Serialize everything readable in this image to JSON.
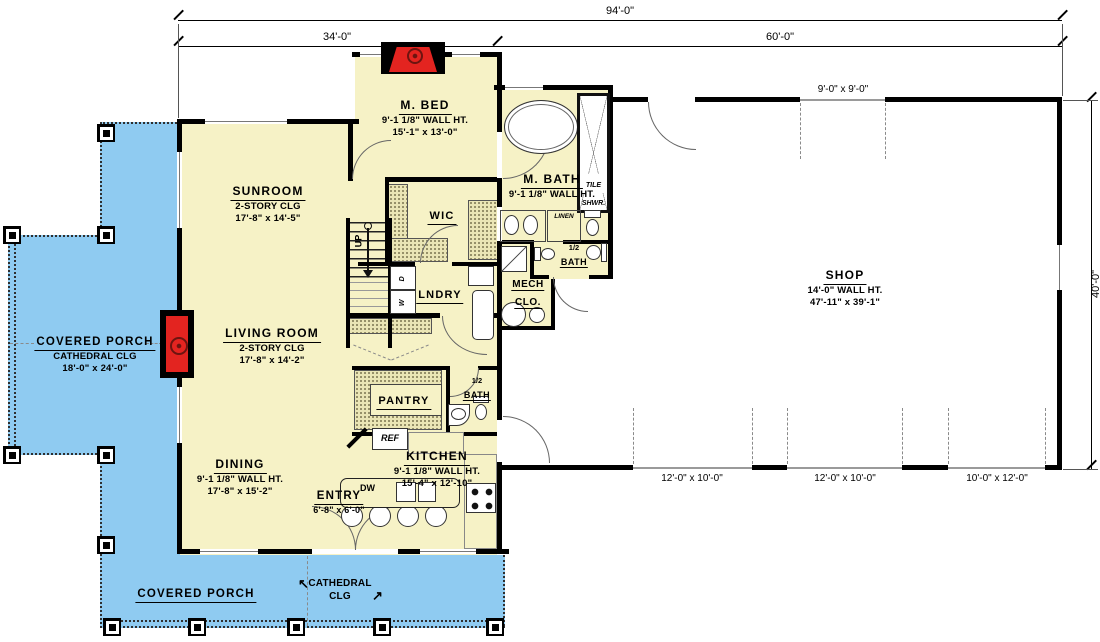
{
  "colors": {
    "porch": "#8fcbf1",
    "house": "#f6f2c6",
    "wall": "#000000",
    "fireplace": "#e32420",
    "shop": "#ffffff"
  },
  "dimensions": {
    "overall_width": "94'-0\"",
    "house_width": "34'-0\"",
    "shop_width": "60'-0\"",
    "shop_depth": "40'-0\"",
    "shop_top_door": "9'-0\" x 9'-0\"",
    "garage_door_1": "12'-0\" x 10'-0\"",
    "garage_door_2": "12'-0\" x 10'-0\"",
    "garage_door_3": "10'-0\" x 12'-0\""
  },
  "rooms": {
    "m_bed": {
      "name": "M. BED",
      "wall_ht": "9'-1 1/8\" WALL HT.",
      "size": "15'-1\" x 13'-0\""
    },
    "sunroom": {
      "name": "SUNROOM",
      "ceiling": "2-STORY CLG",
      "size": "17'-8\" x 14'-5\""
    },
    "m_bath": {
      "name": "M. BATH",
      "wall_ht": "9'-1 1/8\" WALL HT."
    },
    "wic": {
      "name": "WIC"
    },
    "lndry": {
      "name": "LNDRY"
    },
    "mech_clo": {
      "line1": "MECH",
      "line2": "CLO."
    },
    "half_bath_upper": {
      "line1": "1/2",
      "line2": "BATH"
    },
    "half_bath_lower": {
      "line1": "1/2",
      "line2": "BATH"
    },
    "living_room": {
      "name": "LIVING ROOM",
      "ceiling": "2-STORY CLG",
      "size": "17'-8\" x 14'-2\""
    },
    "porch_left": {
      "name": "COVERED PORCH",
      "ceiling": "CATHEDRAL CLG",
      "size": "18'-0\" x 24'-0\""
    },
    "shop": {
      "name": "SHOP",
      "wall_ht": "14'-0\" WALL HT.",
      "size": "47'-11\" x 39'-1\""
    },
    "pantry": {
      "name": "PANTRY"
    },
    "kitchen": {
      "name": "KITCHEN",
      "wall_ht": "9'-1 1/8\" WALL HT.",
      "size": "15'-4\" x 12'-10\""
    },
    "dining": {
      "name": "DINING",
      "wall_ht": "9'-1 1/8\" WALL HT.",
      "size": "17'-8\" x 15'-2\""
    },
    "entry": {
      "name": "ENTRY",
      "size": "6'-8\" x 6'-0\""
    },
    "porch_bottom": {
      "name": "COVERED PORCH",
      "ceiling_line1": "CATHEDRAL",
      "ceiling_line2": "CLG"
    }
  },
  "fixtures": {
    "tile_shwr_line1": "TILE",
    "tile_shwr_line2": "SHWR.",
    "linen": "LINEN",
    "ref": "REF",
    "dw": "DW",
    "up": "UP",
    "washer": "W",
    "dryer": "D"
  }
}
